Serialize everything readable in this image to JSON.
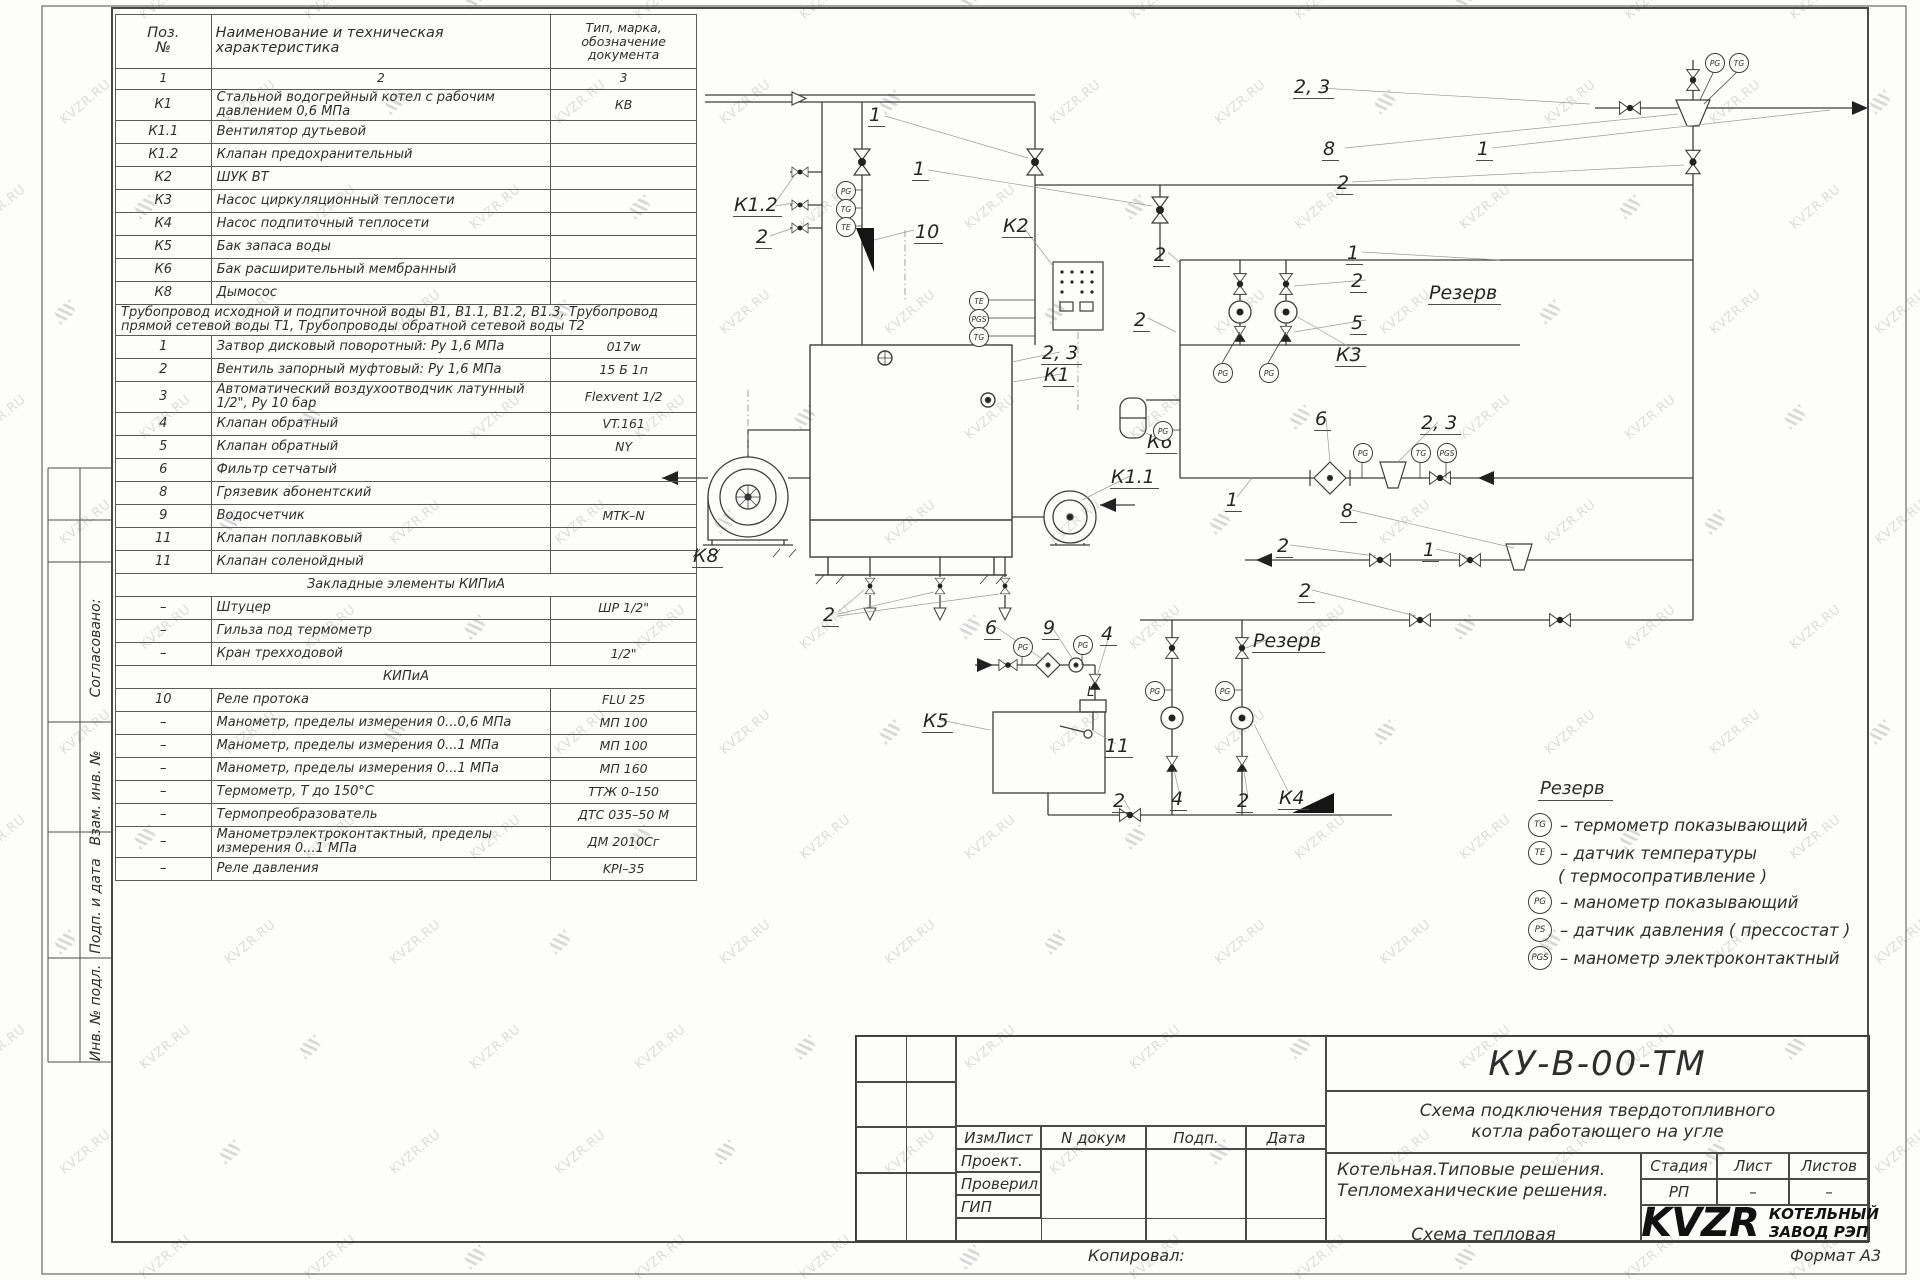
{
  "watermark": {
    "text": "KVZR.RU"
  },
  "parts_table": {
    "header": {
      "pos": "Поз.\n№",
      "name": "Наименование и техническая\nхарактеристика",
      "type": "Тип, марка,\nобозначение\nдокумента"
    },
    "col_numbers": [
      "1",
      "2",
      "3"
    ],
    "rows": [
      {
        "p": "К1",
        "n": "Стальной водогрейный котел с рабочим давлением 0,6  МПа",
        "t": "КВ"
      },
      {
        "p": "К1.1",
        "n": "Вентилятор дутьевой",
        "t": ""
      },
      {
        "p": "К1.2",
        "n": "Клапан предохранительный",
        "t": ""
      },
      {
        "p": "К2",
        "n": "ШУК ВТ",
        "t": ""
      },
      {
        "p": "К3",
        "n": "Насос циркуляционный теплосети",
        "t": ""
      },
      {
        "p": "К4",
        "n": "Насос подпиточный теплосети",
        "t": ""
      },
      {
        "p": "К5",
        "n": "Бак запаса воды",
        "t": ""
      },
      {
        "p": "К6",
        "n": "Бак расширительный мембранный",
        "t": ""
      },
      {
        "p": "К8",
        "n": "Дымосос",
        "t": ""
      },
      {
        "full": "Трубопровод исходной и подпиточной воды В1,   В1.1,   В1.2, В1.3,  Трубопровод прямой сетевой воды Т1,  Трубопроводы обратной сетевой воды Т2"
      },
      {
        "p": "1",
        "n": "Затвор дисковый поворотный:  Ру 1,6  МПа",
        "t": "017w"
      },
      {
        "p": "2",
        "n": "Вентиль запорный муфтовый:  Ру 1,6  МПа",
        "t": "15 Б 1п"
      },
      {
        "p": "3",
        "n": "Автоматический воздухоотводчик  латунный 1/2\",  Ру  10  бар",
        "t": "Flexvent 1/2"
      },
      {
        "p": "4",
        "n": "Клапан обратный",
        "t": "VT.161"
      },
      {
        "p": "5",
        "n": "Клапан обратный",
        "t": "NY"
      },
      {
        "p": "6",
        "n": "Фильтр сетчатый",
        "t": ""
      },
      {
        "p": "8",
        "n": "Грязевик абонентский",
        "t": ""
      },
      {
        "p": "9",
        "n": "Водосчетчик",
        "t": "MTK–N"
      },
      {
        "p": "11",
        "n": "Клапан поплавковый",
        "t": ""
      },
      {
        "p": "11",
        "n": "Клапан соленойдный",
        "t": ""
      },
      {
        "sec": "Закладные элементы КИПиА"
      },
      {
        "p": "–",
        "n": "Штуцер",
        "t": "ШР  1/2\""
      },
      {
        "p": "–",
        "n": "Гильза под термометр",
        "t": ""
      },
      {
        "p": "–",
        "n": "Кран трехходовой",
        "t": "1/2\""
      },
      {
        "sec": "КИПиА"
      },
      {
        "p": "10",
        "n": "Реле протока",
        "t": "FLU 25"
      },
      {
        "p": "–",
        "n": "Манометр, пределы измерения  0...0,6 МПа",
        "t": "МП 100"
      },
      {
        "p": "–",
        "n": "Манометр, пределы измерения  0...1 МПа",
        "t": "МП 100"
      },
      {
        "p": "–",
        "n": "Манометр, пределы измерения  0...1 МПа",
        "t": "МП 160"
      },
      {
        "p": "–",
        "n": "Термометр,  Т  до  150°С",
        "t": "ТТЖ  0–150"
      },
      {
        "p": "–",
        "n": "Термопреобразователь",
        "t": "ДТС 035–50 М"
      },
      {
        "p": "–",
        "n": "Манометрэлектроконтактный,  пределы измерения 0...1 МПа",
        "t": "ДМ 2010Сг"
      },
      {
        "p": "–",
        "n": "Реле давления",
        "t": "KPI–35"
      }
    ]
  },
  "side_labels": [
    {
      "text": "Согласовано:",
      "x": 96,
      "y": 640
    },
    {
      "text": "Взам. инв. №",
      "x": 96,
      "y": 790
    },
    {
      "text": "Подп. и дата",
      "x": 96,
      "y": 898
    },
    {
      "text": "Инв. № подл.",
      "x": 96,
      "y": 1005
    }
  ],
  "diagram": {
    "labels": [
      {
        "t": "1",
        "x": 868,
        "y": 106
      },
      {
        "t": "1",
        "x": 912,
        "y": 160
      },
      {
        "t": "К1.2",
        "x": 733,
        "y": 196
      },
      {
        "t": "2",
        "x": 755,
        "y": 228
      },
      {
        "t": "10",
        "x": 914,
        "y": 223
      },
      {
        "t": "К2",
        "x": 1002,
        "y": 217
      },
      {
        "t": "2, 3",
        "x": 1293,
        "y": 78
      },
      {
        "t": "8",
        "x": 1322,
        "y": 140
      },
      {
        "t": "2",
        "x": 1336,
        "y": 174
      },
      {
        "t": "1",
        "x": 1476,
        "y": 140
      },
      {
        "t": "2",
        "x": 1153,
        "y": 246
      },
      {
        "t": "1",
        "x": 1346,
        "y": 244
      },
      {
        "t": "2",
        "x": 1350,
        "y": 272
      },
      {
        "t": "5",
        "x": 1350,
        "y": 314
      },
      {
        "t": "К3",
        "x": 1335,
        "y": 346
      },
      {
        "t": "2",
        "x": 1133,
        "y": 311
      },
      {
        "t": "Резерв",
        "x": 1428,
        "y": 284
      },
      {
        "t": "2, 3",
        "x": 1041,
        "y": 344
      },
      {
        "t": "К1",
        "x": 1043,
        "y": 366
      },
      {
        "t": "6",
        "x": 1314,
        "y": 410
      },
      {
        "t": "2, 3",
        "x": 1420,
        "y": 414
      },
      {
        "t": "К6",
        "x": 1146,
        "y": 433
      },
      {
        "t": "К1.1",
        "x": 1110,
        "y": 468
      },
      {
        "t": "1",
        "x": 1225,
        "y": 491
      },
      {
        "t": "8",
        "x": 1340,
        "y": 502
      },
      {
        "t": "2",
        "x": 1276,
        "y": 537
      },
      {
        "t": "1",
        "x": 1422,
        "y": 541
      },
      {
        "t": "К8",
        "x": 692,
        "y": 547
      },
      {
        "t": "2",
        "x": 1298,
        "y": 582
      },
      {
        "t": "2",
        "x": 822,
        "y": 606
      },
      {
        "t": "6",
        "x": 984,
        "y": 619
      },
      {
        "t": "9",
        "x": 1042,
        "y": 619
      },
      {
        "t": "4",
        "x": 1100,
        "y": 625
      },
      {
        "t": "Резерв",
        "x": 1252,
        "y": 632
      },
      {
        "t": "К5",
        "x": 922,
        "y": 712
      },
      {
        "t": "11",
        "x": 1104,
        "y": 737
      },
      {
        "t": "L",
        "x": 1086,
        "y": 686,
        "small": true
      },
      {
        "t": "2",
        "x": 1112,
        "y": 792
      },
      {
        "t": "4",
        "x": 1170,
        "y": 790
      },
      {
        "t": "2",
        "x": 1236,
        "y": 792
      },
      {
        "t": "К4",
        "x": 1278,
        "y": 789
      }
    ],
    "bubbles": [
      {
        "x": 845,
        "y": 190,
        "t": "PG"
      },
      {
        "x": 845,
        "y": 208,
        "t": "TG"
      },
      {
        "x": 845,
        "y": 226,
        "t": "TE"
      },
      {
        "x": 978,
        "y": 300,
        "t": "TE"
      },
      {
        "x": 978,
        "y": 318,
        "t": "PGS"
      },
      {
        "x": 978,
        "y": 336,
        "t": "TG"
      },
      {
        "x": 1714,
        "y": 62,
        "t": "PG"
      },
      {
        "x": 1738,
        "y": 62,
        "t": "TG"
      },
      {
        "x": 1222,
        "y": 372,
        "t": "PG"
      },
      {
        "x": 1268,
        "y": 372,
        "t": "PG"
      },
      {
        "x": 1362,
        "y": 452,
        "t": "PG"
      },
      {
        "x": 1420,
        "y": 452,
        "t": "TG"
      },
      {
        "x": 1446,
        "y": 452,
        "t": "PGS"
      },
      {
        "x": 1162,
        "y": 430,
        "t": "PG"
      },
      {
        "x": 1022,
        "y": 646,
        "t": "PG"
      },
      {
        "x": 1082,
        "y": 644,
        "t": "PG"
      },
      {
        "x": 1154,
        "y": 690,
        "t": "PG"
      },
      {
        "x": 1224,
        "y": 690,
        "t": "PG"
      }
    ]
  },
  "legend": {
    "title": "Резерв",
    "items": [
      {
        "s": "TG",
        "t": "–  термометр показывающий"
      },
      {
        "s": "TE",
        "t": "–  датчик температуры"
      },
      {
        "s": "",
        "t": "( термосопративление )"
      },
      {
        "s": "PG",
        "t": "–  манометр показывающий"
      },
      {
        "s": "PS",
        "t": "–  датчик давления  ( прессостат )"
      },
      {
        "s": "PGS",
        "t": "–  манометр электроконтактный"
      }
    ]
  },
  "title_block": {
    "doc_number": "КУ-В-00-ТМ",
    "title_line1": "Схема подключения твердотопливного",
    "title_line2": "котла работающего на угле",
    "org_line1": "Котельная.Типовые решения.",
    "org_line2": "Тепломеханические решения.",
    "scheme_name": "Схема тепловая",
    "stage_label": "Стадия",
    "sheet_label": "Лист",
    "sheets_label": "Листов",
    "stage_value": "РП",
    "sheet_value": "–",
    "sheets_value": "–",
    "col_izm": "ИзмЛист",
    "col_doc": "N докум",
    "col_sign": "Подп.",
    "col_date": "Дата",
    "row_proj": "Проект.",
    "row_check": "Проверил",
    "row_gip": "ГИП",
    "logo_text": "KVZR",
    "company_line1": "КОТЕЛЬНЫЙ",
    "company_line2": "ЗАВОД РЭП",
    "copied": "Копировал:",
    "format": "Формат А3"
  }
}
